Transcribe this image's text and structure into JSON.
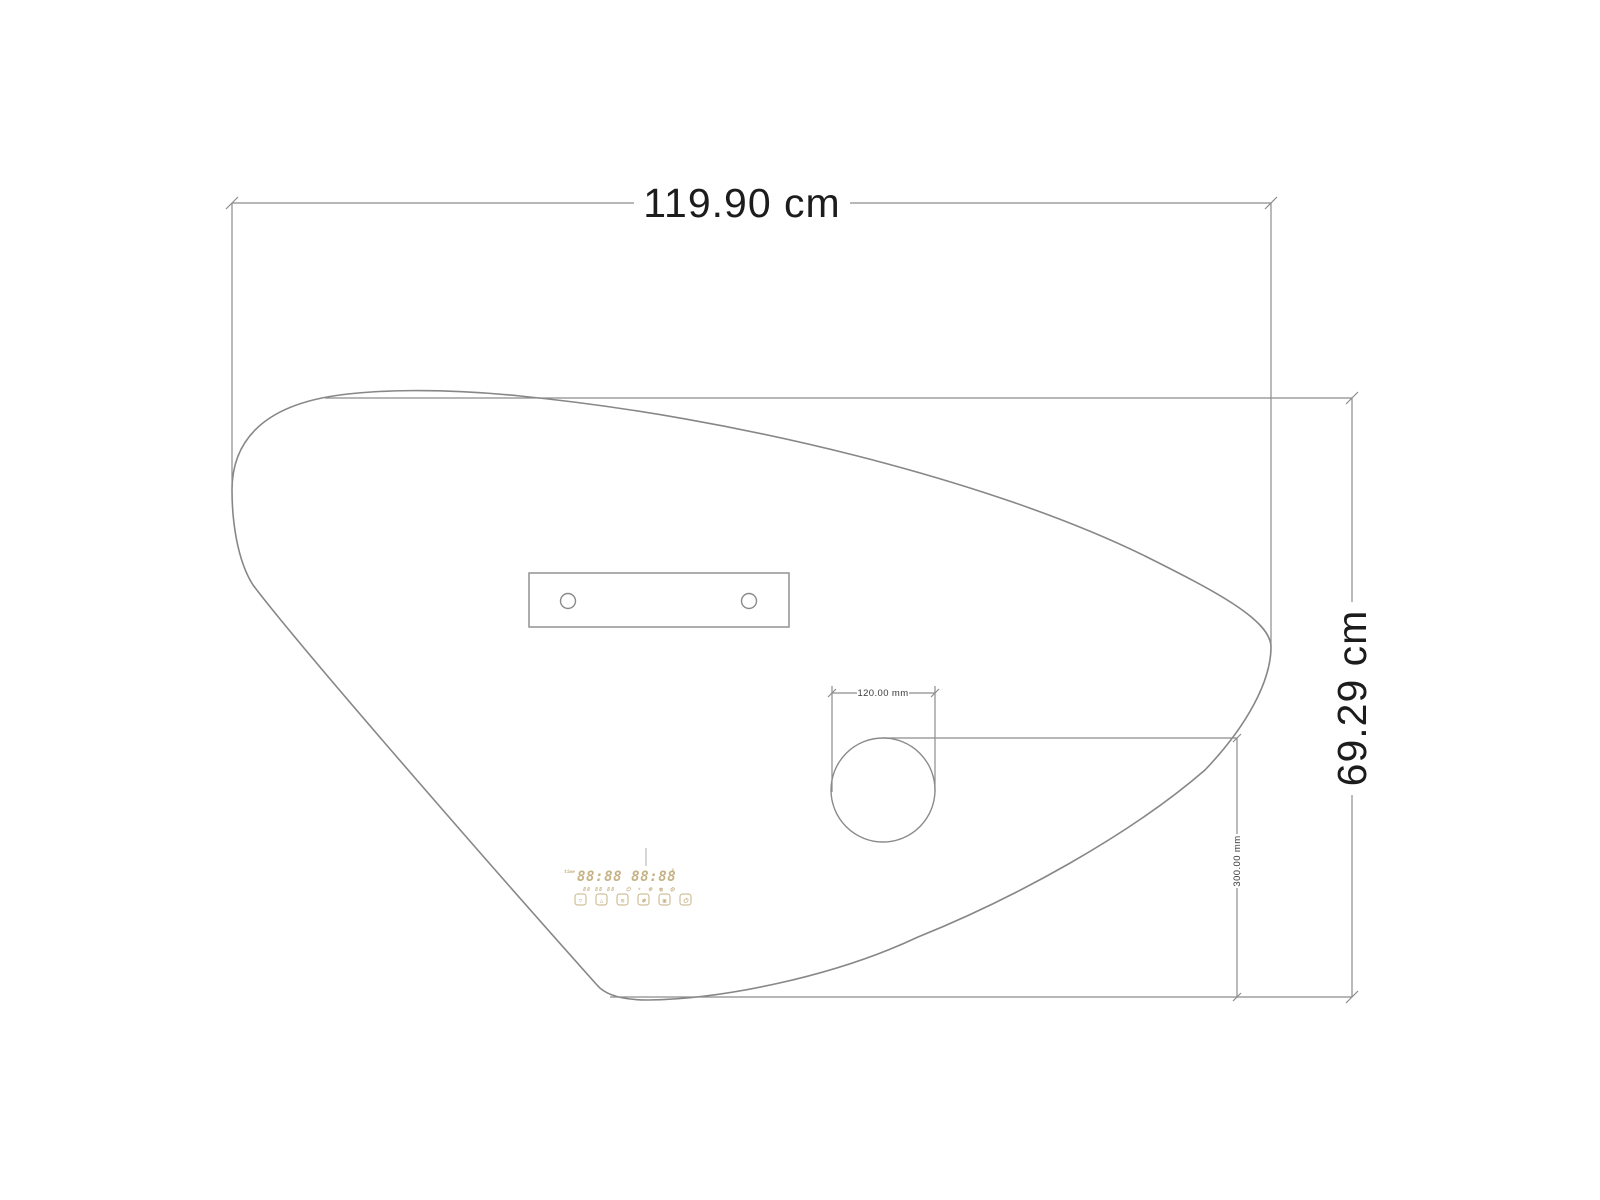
{
  "title": "Asymmetric mirror technical drawing",
  "dimensions": {
    "width": "119.90 cm",
    "height": "69.29 cm",
    "magnifier_diameter": "120.00 mm",
    "magnifier_bottom_offset": "300.00 mm"
  },
  "display": {
    "clock": "88:88 88:88",
    "degree_mark": "°",
    "left_tag": "time",
    "status_left": "88 88 88",
    "status_right": "⏻ ☀ ❄ ▦ ⚙",
    "buttons": [
      "▽",
      "△",
      "≋",
      "❄",
      "▣",
      "⏻"
    ]
  },
  "colors": {
    "line": "#8c8c8c",
    "outline": "#878787",
    "dim_text": "#1c1c1c",
    "panel": "#c6b184"
  }
}
